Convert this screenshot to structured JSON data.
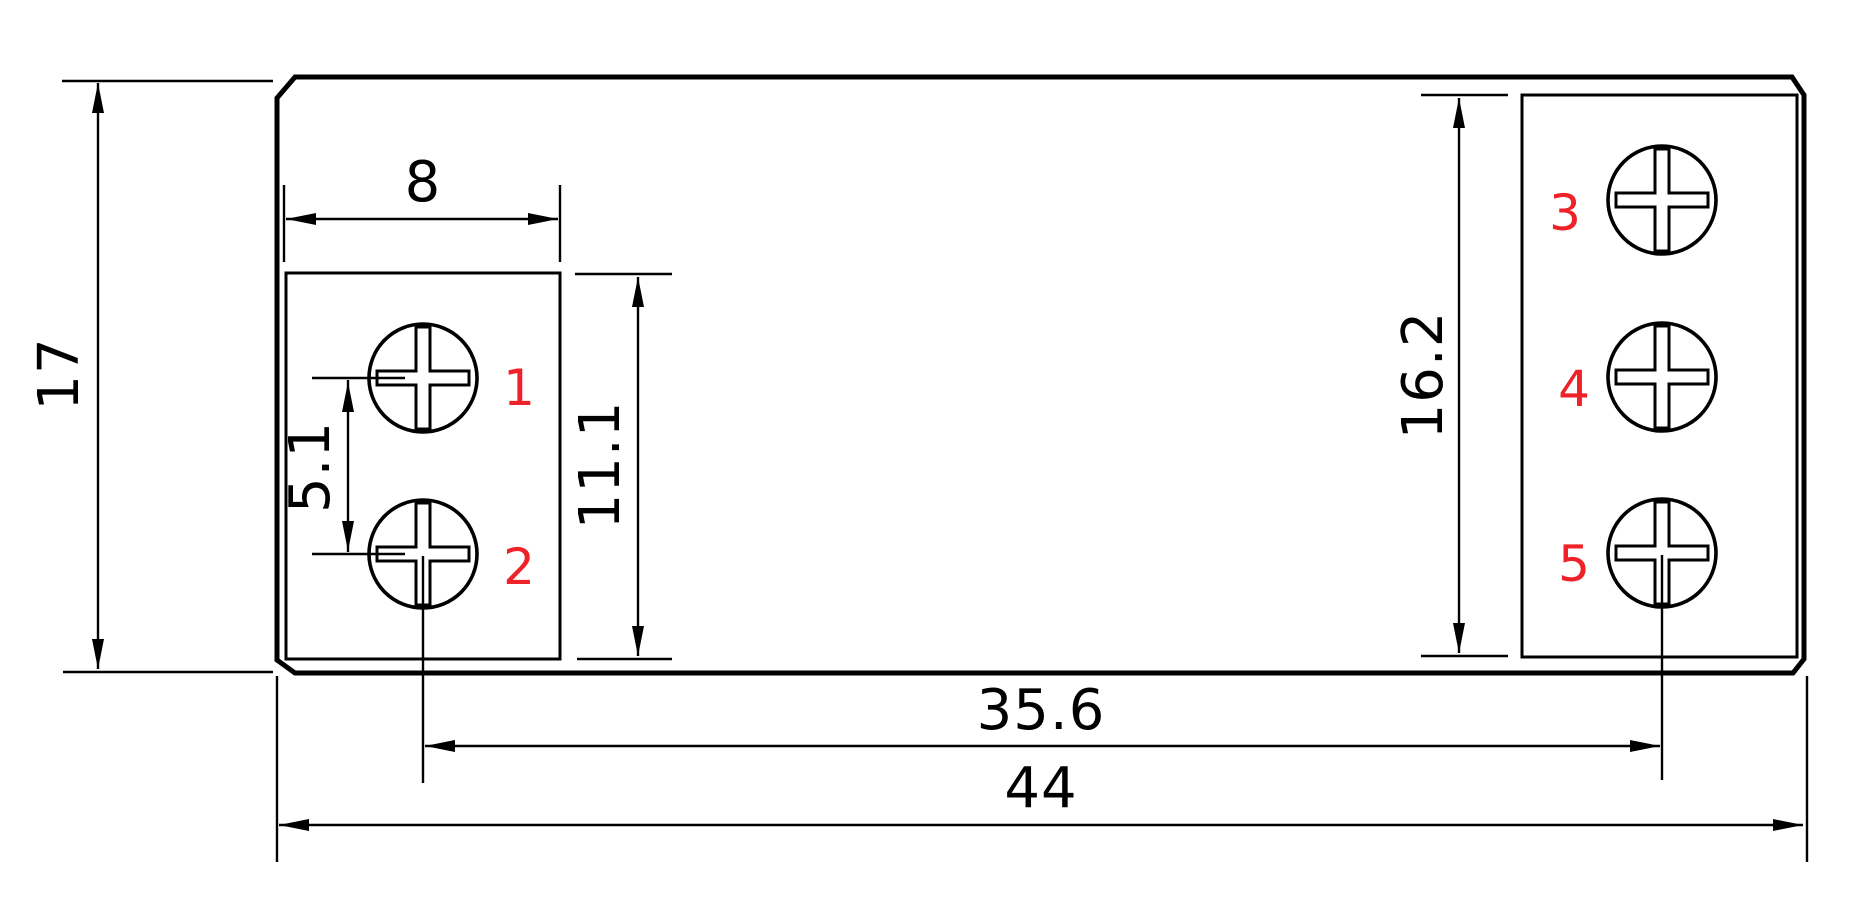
{
  "drawing": {
    "background_color": "#ffffff",
    "line_color": "#000000",
    "terminal_number_color": "#ee2228",
    "dimensions": {
      "height_overall": "17",
      "left_block_width": "8",
      "terminal_pitch": "5.1",
      "left_block_height": "11.1",
      "right_block_height": "16.2",
      "terminal_span": "35.6",
      "width_overall": "44"
    },
    "terminals": [
      {
        "number": "1"
      },
      {
        "number": "2"
      },
      {
        "number": "3"
      },
      {
        "number": "4"
      },
      {
        "number": "5"
      }
    ]
  }
}
